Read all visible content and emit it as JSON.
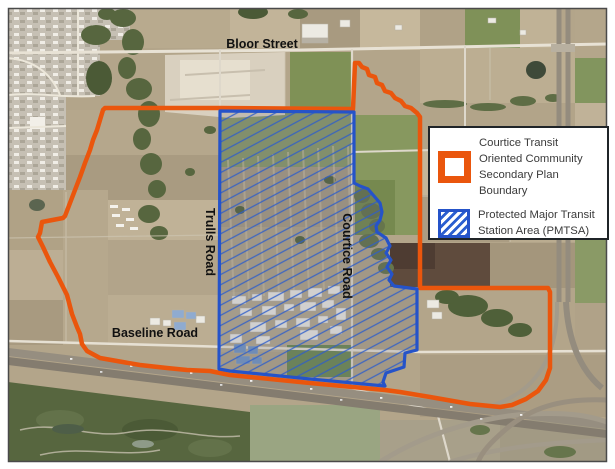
{
  "map": {
    "labels": {
      "bloor_street": "Bloor Street",
      "trulls_road": "Trulls Road",
      "courtice_road": "Courtice Road",
      "baseline_road": "Baseline Road"
    },
    "colors": {
      "secondary_plan_boundary_orange": "#EA560D",
      "pmtsa_blue": "#2553C9"
    }
  },
  "legend": {
    "items": [
      {
        "id": "secondary-plan-boundary",
        "swatch": "orange-outline-icon",
        "label": "Courtice Transit Oriented Community Secondary Plan Boundary"
      },
      {
        "id": "pmtsa",
        "swatch": "blue-hatch-icon",
        "label": "Protected Major Transit Station Area (PMTSA)"
      }
    ]
  }
}
